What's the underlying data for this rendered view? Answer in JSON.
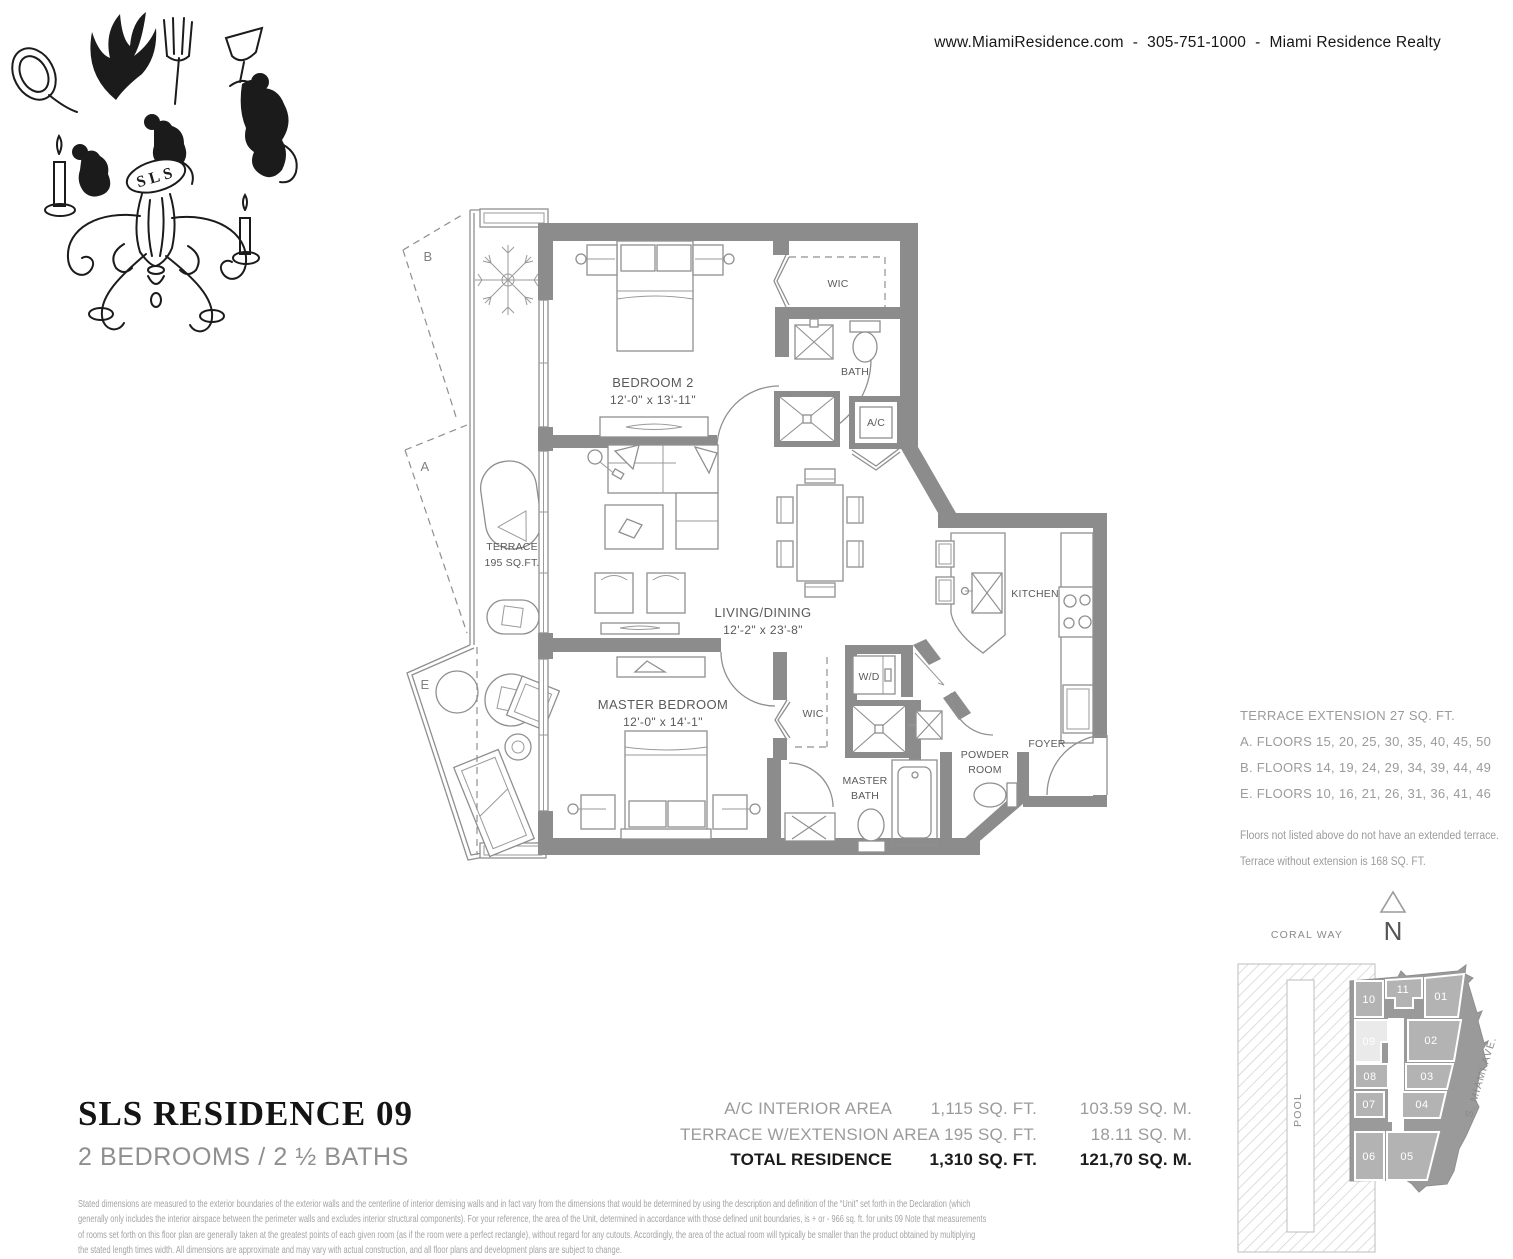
{
  "header": {
    "contact": "www.MiamiResidence.com  -  305-751-1000  -  Miami Residence Realty"
  },
  "logo": {
    "monogram": "SLS"
  },
  "floorplan": {
    "rooms": {
      "bedroom2": "BEDROOM 2",
      "bedroom2_dim": "12'-0\" x 13'-11\"",
      "wic2": "WIC",
      "bath": "BATH",
      "ac": "A/C",
      "living": "LIVING/DINING",
      "living_dim": "12'-2\" x 23'-8\"",
      "kitchen": "KITCHEN",
      "master": "MASTER BEDROOM",
      "master_dim": "12'-0\" x 14'-1\"",
      "wic_master": "WIC",
      "wd": "W/D",
      "master_bath_1": "MASTER",
      "master_bath_2": "BATH",
      "powder_1": "POWDER",
      "powder_2": "ROOM",
      "foyer": "FOYER",
      "terrace_1": "TERRACE",
      "terrace_2": "195 SQ.FT."
    },
    "markers": {
      "a": "A",
      "b": "B",
      "e": "E"
    }
  },
  "terrace_notes": {
    "title": "TERRACE EXTENSION 27 SQ. FT.",
    "lines": [
      "A. FLOORS 15, 20, 25, 30, 35, 40, 45, 50",
      "B. FLOORS 14, 19, 24, 29, 34, 39, 44, 49",
      "E. FLOORS 10, 16, 21, 26, 31, 36, 41, 46"
    ],
    "note1": "Floors not listed above do not have an extended terrace.",
    "note2": "Terrace without extension is 168 SQ. FT."
  },
  "siteplan": {
    "street_top": "CORAL WAY",
    "north": "N",
    "pool": "POOL",
    "street_right": "S. MIAMI AVE.",
    "units": [
      "10",
      "11",
      "01",
      "09",
      "02",
      "08",
      "03",
      "07",
      "04",
      "06",
      "05"
    ],
    "highlight_unit": "09",
    "colors": {
      "building": "#9a9a9a",
      "cell": "#b3b3b3",
      "highlight": "#eaeaea"
    }
  },
  "title_block": {
    "title": "SLS RESIDENCE 09",
    "subtitle": "2 BEDROOMS / 2 ½ BATHS"
  },
  "area_table": {
    "rows": [
      {
        "label": "A/C INTERIOR AREA",
        "sqft": "1,115 SQ. FT.",
        "sqm": "103.59 SQ. M."
      },
      {
        "label": "TERRACE W/EXTENSION AREA",
        "sqft": "195 SQ. FT.",
        "sqm": "18.11 SQ. M."
      },
      {
        "label": "TOTAL RESIDENCE",
        "sqft": "1,310 SQ. FT.",
        "sqm": "121,70 SQ. M."
      }
    ]
  },
  "disclaimer": {
    "lines": [
      "Stated dimensions are measured to the exterior boundaries of the exterior walls and the centerline of interior demising walls and in fact vary from the dimensions that would be determined by using the description and definition of the “Unit” set forth in the Declaration (which",
      "generally only includes the interior airspace between the perimeter walls and excludes interior structural components). For your reference, the area of the Unit, determined in accordance with those defined unit boundaries, is + or - 966 sq. ft. for units 09 Note that measurements",
      "of rooms set forth on this floor plan are generally taken at the greatest points of each given room (as if the room were a perfect rectangle), without regard for any cutouts. Accordingly, the area of the actual room will typically be smaller than the product obtained by multiplying",
      "the stated length times width. All dimensions are approximate and may vary with actual construction, and all floor plans and development plans are subject to change."
    ]
  },
  "colors": {
    "wall": "#8c8c8c",
    "accent_gray": "#9b9b9b",
    "ink": "#1b1b1b"
  }
}
